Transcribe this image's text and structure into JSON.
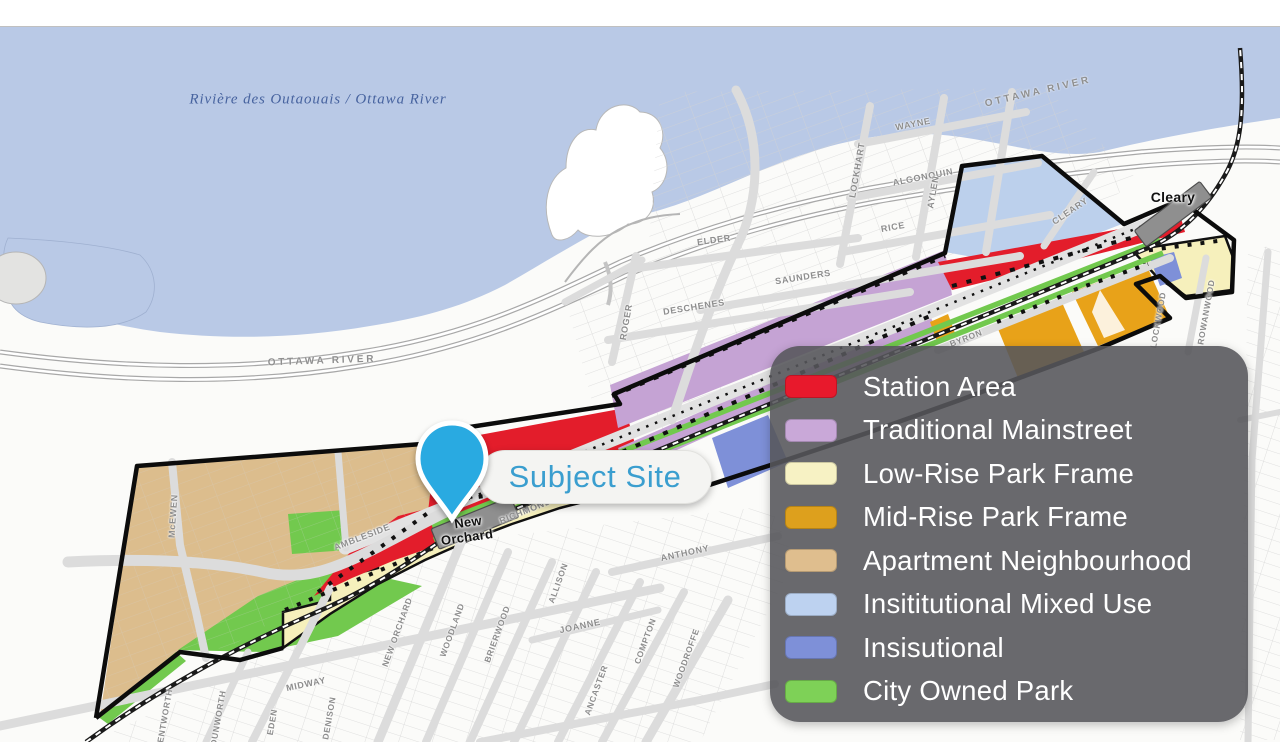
{
  "map": {
    "water_label": "Rivière des Outaouais / Ottawa River",
    "subject_site_label": "Subject Site",
    "stations": [
      "New Orchard",
      "Cleary"
    ],
    "labels": [
      {
        "text": "Rivière des Outaouais / Ottawa River",
        "kind": "water",
        "x": 318,
        "y": 100,
        "rot": 0,
        "size": 15
      },
      {
        "text": "OTTAWA RIVER",
        "kind": "parkway",
        "x": 322,
        "y": 361,
        "rot": -2,
        "size": 10
      },
      {
        "text": "OTTAWA RIVER",
        "kind": "parkway",
        "x": 1038,
        "y": 92,
        "rot": -13,
        "size": 10
      },
      {
        "text": "WAYNE",
        "kind": "street",
        "x": 913,
        "y": 124,
        "rot": -11,
        "size": 9
      },
      {
        "text": "LOCKHART",
        "kind": "street",
        "x": 857,
        "y": 170,
        "rot": -80,
        "size": 9
      },
      {
        "text": "ALGONQUIN",
        "kind": "street",
        "x": 923,
        "y": 177,
        "rot": -11,
        "size": 9
      },
      {
        "text": "AYLEN",
        "kind": "street",
        "x": 933,
        "y": 192,
        "rot": -80,
        "size": 9
      },
      {
        "text": "RICE",
        "kind": "street",
        "x": 893,
        "y": 227,
        "rot": -10,
        "size": 9
      },
      {
        "text": "ELDER",
        "kind": "street",
        "x": 714,
        "y": 240,
        "rot": -8,
        "size": 9
      },
      {
        "text": "SAUNDERS",
        "kind": "street",
        "x": 803,
        "y": 277,
        "rot": -9,
        "size": 9
      },
      {
        "text": "DESCHENES",
        "kind": "street",
        "x": 694,
        "y": 307,
        "rot": -9,
        "size": 9
      },
      {
        "text": "ROGER",
        "kind": "street",
        "x": 626,
        "y": 322,
        "rot": -80,
        "size": 9
      },
      {
        "text": "McEWEN",
        "kind": "street",
        "x": 173,
        "y": 516,
        "rot": -86,
        "size": 9
      },
      {
        "text": "AMBLESIDE",
        "kind": "street",
        "x": 362,
        "y": 537,
        "rot": -21,
        "size": 9
      },
      {
        "text": "RICHMOND RD.",
        "kind": "street",
        "x": 535,
        "y": 507,
        "rot": -22,
        "size": 9
      },
      {
        "text": "NEW ORCHARD",
        "kind": "street",
        "x": 397,
        "y": 632,
        "rot": -70,
        "size": 8.5
      },
      {
        "text": "WOODLAND",
        "kind": "street",
        "x": 452,
        "y": 630,
        "rot": -70,
        "size": 8.5
      },
      {
        "text": "BRIERWOOD",
        "kind": "street",
        "x": 497,
        "y": 634,
        "rot": -70,
        "size": 8.5
      },
      {
        "text": "MIDWAY",
        "kind": "street",
        "x": 306,
        "y": 684,
        "rot": -12,
        "size": 9
      },
      {
        "text": "ANTHONY",
        "kind": "street",
        "x": 685,
        "y": 553,
        "rot": -12,
        "size": 9
      },
      {
        "text": "JOANNE",
        "kind": "street",
        "x": 580,
        "y": 626,
        "rot": -12,
        "size": 9
      },
      {
        "text": "ALLISON",
        "kind": "street",
        "x": 558,
        "y": 583,
        "rot": -70,
        "size": 8.5
      },
      {
        "text": "ANCASTER",
        "kind": "street",
        "x": 596,
        "y": 690,
        "rot": -70,
        "size": 8.5
      },
      {
        "text": "COMPTON",
        "kind": "street",
        "x": 645,
        "y": 641,
        "rot": -70,
        "size": 8.5
      },
      {
        "text": "WOODROFFE",
        "kind": "street",
        "x": 686,
        "y": 658,
        "rot": -70,
        "size": 8.5
      },
      {
        "text": "BYRON",
        "kind": "street",
        "x": 966,
        "y": 338,
        "rot": -21,
        "size": 8.5
      },
      {
        "text": "CLEARY",
        "kind": "street",
        "x": 1070,
        "y": 211,
        "rot": -34,
        "size": 9
      },
      {
        "text": "ROWANWOOD",
        "kind": "street",
        "x": 1206,
        "y": 312,
        "rot": -80,
        "size": 8.5
      },
      {
        "text": "LOCKWOOD",
        "kind": "street",
        "x": 1158,
        "y": 320,
        "rot": -80,
        "size": 8.5
      },
      {
        "text": "WENTWORTH",
        "kind": "street",
        "x": 164,
        "y": 720,
        "rot": -80,
        "size": 8.5
      },
      {
        "text": "DUNWORTH",
        "kind": "street",
        "x": 218,
        "y": 718,
        "rot": -80,
        "size": 8.5
      },
      {
        "text": "EDEN",
        "kind": "street",
        "x": 272,
        "y": 722,
        "rot": -80,
        "size": 8.5
      },
      {
        "text": "DENISON",
        "kind": "street",
        "x": 329,
        "y": 718,
        "rot": -80,
        "size": 8.5
      },
      {
        "text": "New",
        "kind": "station",
        "x": 468,
        "y": 522,
        "rot": -8,
        "size": 13
      },
      {
        "text": "Orchard",
        "kind": "station",
        "x": 467,
        "y": 537,
        "rot": -8,
        "size": 13
      },
      {
        "text": "Cleary",
        "kind": "station",
        "x": 1173,
        "y": 197,
        "rot": 0,
        "size": 14
      }
    ]
  },
  "legend": {
    "items": [
      {
        "label": "Station Area",
        "color": "#e8192c"
      },
      {
        "label": "Traditional Mainstreet",
        "color": "#c9a8d8"
      },
      {
        "label": "Low-Rise Park Frame",
        "color": "#f7f2c4"
      },
      {
        "label": "Mid-Rise Park Frame",
        "color": "#dda01d"
      },
      {
        "label": "Apartment Neighbourhood",
        "color": "#dfbe8e"
      },
      {
        "label": "Insititutional Mixed Use",
        "color": "#bdd2f0"
      },
      {
        "label": "Insisutional",
        "color": "#7e90d8"
      },
      {
        "label": "City Owned Park",
        "color": "#7ed157"
      }
    ]
  },
  "colors": {
    "water": "#b9c9e6",
    "station_area": "#e31d2b",
    "traditional_mainstreet": "#c5a3d4",
    "low_rise_park_frame": "#f6f0bc",
    "mid_rise_park_frame": "#e8a219",
    "apartment_neighbourhood": "#dcbd8d",
    "institutional_mixed_use": "#bcd0ec",
    "institutional": "#7e90d8",
    "city_owned_park": "#72c94e",
    "subject_pin": "#29aae1",
    "subject_text": "#3a9ecf"
  }
}
